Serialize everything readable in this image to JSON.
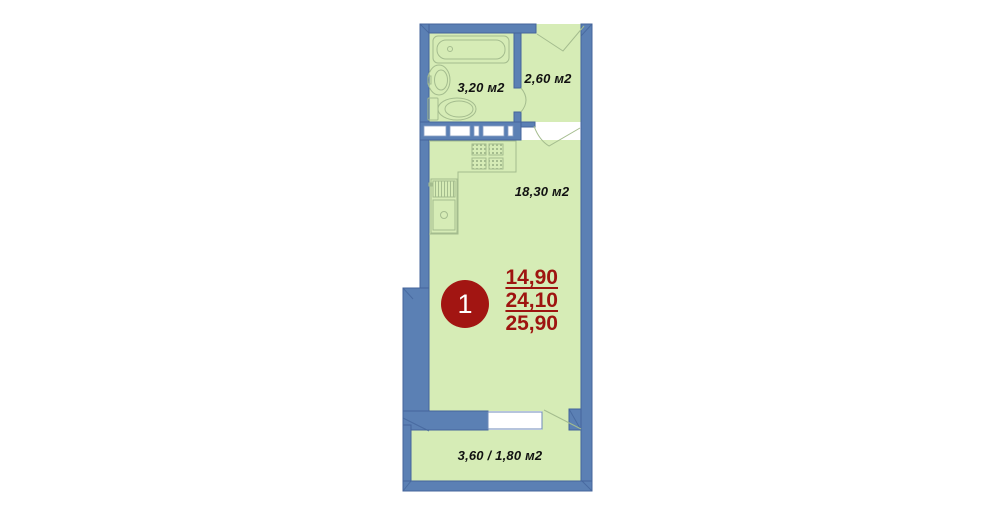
{
  "floor_plan": {
    "unit_marker": {
      "number": "1"
    },
    "area_summary": {
      "living_area": "14,90",
      "total_area": "24,10",
      "total_with_balcony": "25,90"
    },
    "rooms": {
      "bathroom": {
        "area": "3,20 м2"
      },
      "hallway": {
        "area": "2,60 м2"
      },
      "living_room": {
        "area": "18,30 м2"
      },
      "balcony": {
        "area": "3,60 / 1,80 м2"
      }
    },
    "colors": {
      "wall_blue": "#5b80b4",
      "wall_edge": "#44649b",
      "floor_green": "#d6ecb6",
      "fixture_outline": "#a4bc8e",
      "marker_red": "#a21512",
      "area_text_red": "#9e1410"
    }
  }
}
